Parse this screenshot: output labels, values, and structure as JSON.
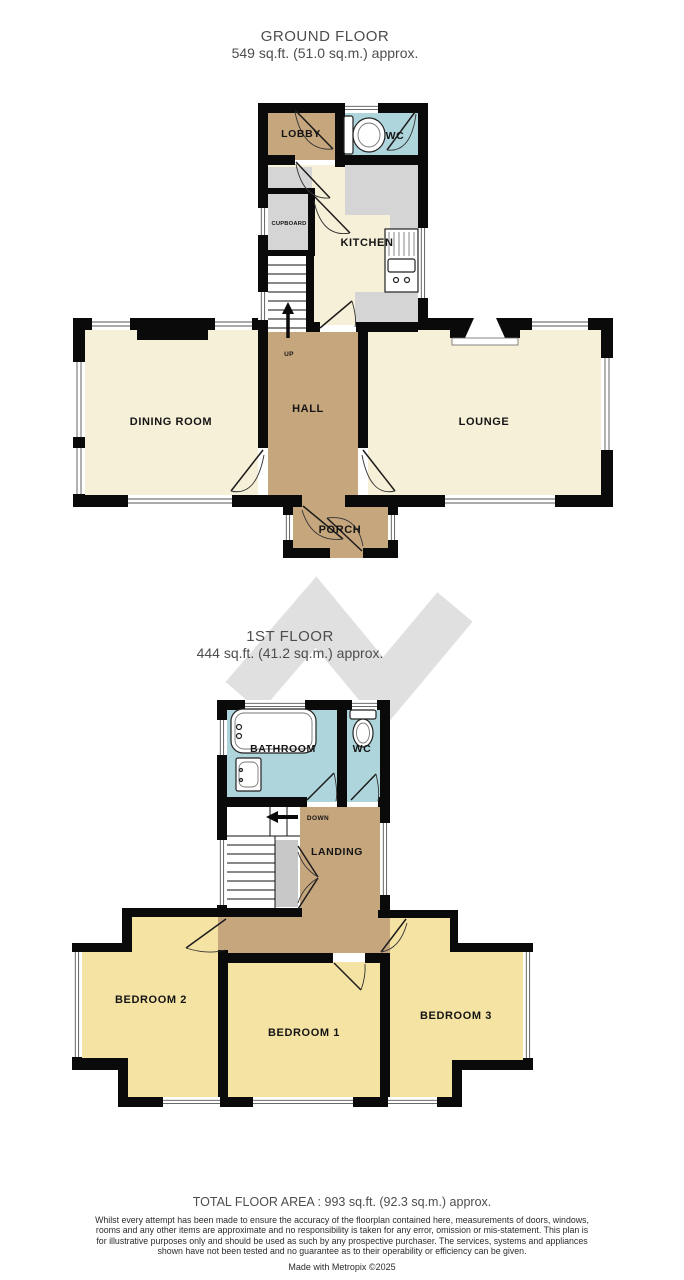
{
  "ground_floor": {
    "title": "GROUND FLOOR",
    "subtitle": "549 sq.ft. (51.0 sq.m.) approx.",
    "rooms": {
      "lobby": "LOBBY",
      "wc": "WC",
      "cupboard": "CUPBOARD",
      "kitchen": "KITCHEN",
      "dining": "DINING ROOM",
      "hall": "HALL",
      "lounge": "LOUNGE",
      "porch": "PORCH",
      "stairs_direction": "UP"
    }
  },
  "first_floor": {
    "title": "1ST FLOOR",
    "subtitle": "444 sq.ft. (41.2 sq.m.) approx.",
    "rooms": {
      "bathroom": "BATHROOM",
      "wc": "WC",
      "landing": "LANDING",
      "bedroom1": "BEDROOM 1",
      "bedroom2": "BEDROOM 2",
      "bedroom3": "BEDROOM 3",
      "stairs_direction": "DOWN"
    }
  },
  "footer": {
    "total_area": "TOTAL FLOOR AREA : 993 sq.ft. (92.3 sq.m.) approx.",
    "disclaimer": "Whilst every attempt has been made to ensure the accuracy of the floorplan contained here, measurements of doors, windows, rooms and any other items are approximate and no responsibility is taken for any error, omission or mis-statement. This plan is for illustrative purposes only and should be used as such by any prospective purchaser. The services, systems and appliances shown have not been tested and no guarantee as to their operability or efficiency can be given.",
    "credit": "Made with Metropix ©2025"
  },
  "icons": {
    "watermark": "metropix-logo-watermark",
    "fixtures": [
      "toilet-icon",
      "bathtub-icon",
      "basin-icon",
      "kitchen-sink-icon"
    ],
    "arrows": [
      "up-arrow-icon",
      "down-arrow-icon"
    ]
  },
  "colors": {
    "wall": "#0a0a0a",
    "room_cream": "#f7f0d8",
    "circulation_tan": "#c6a67d",
    "wet_room_blue": "#afd5dc",
    "bedroom_yellow": "#f5e3a4",
    "storage_gray": "#d5d5d5",
    "watermark_gray": "#e0e0e0",
    "title_gray": "#4d4d4d"
  }
}
